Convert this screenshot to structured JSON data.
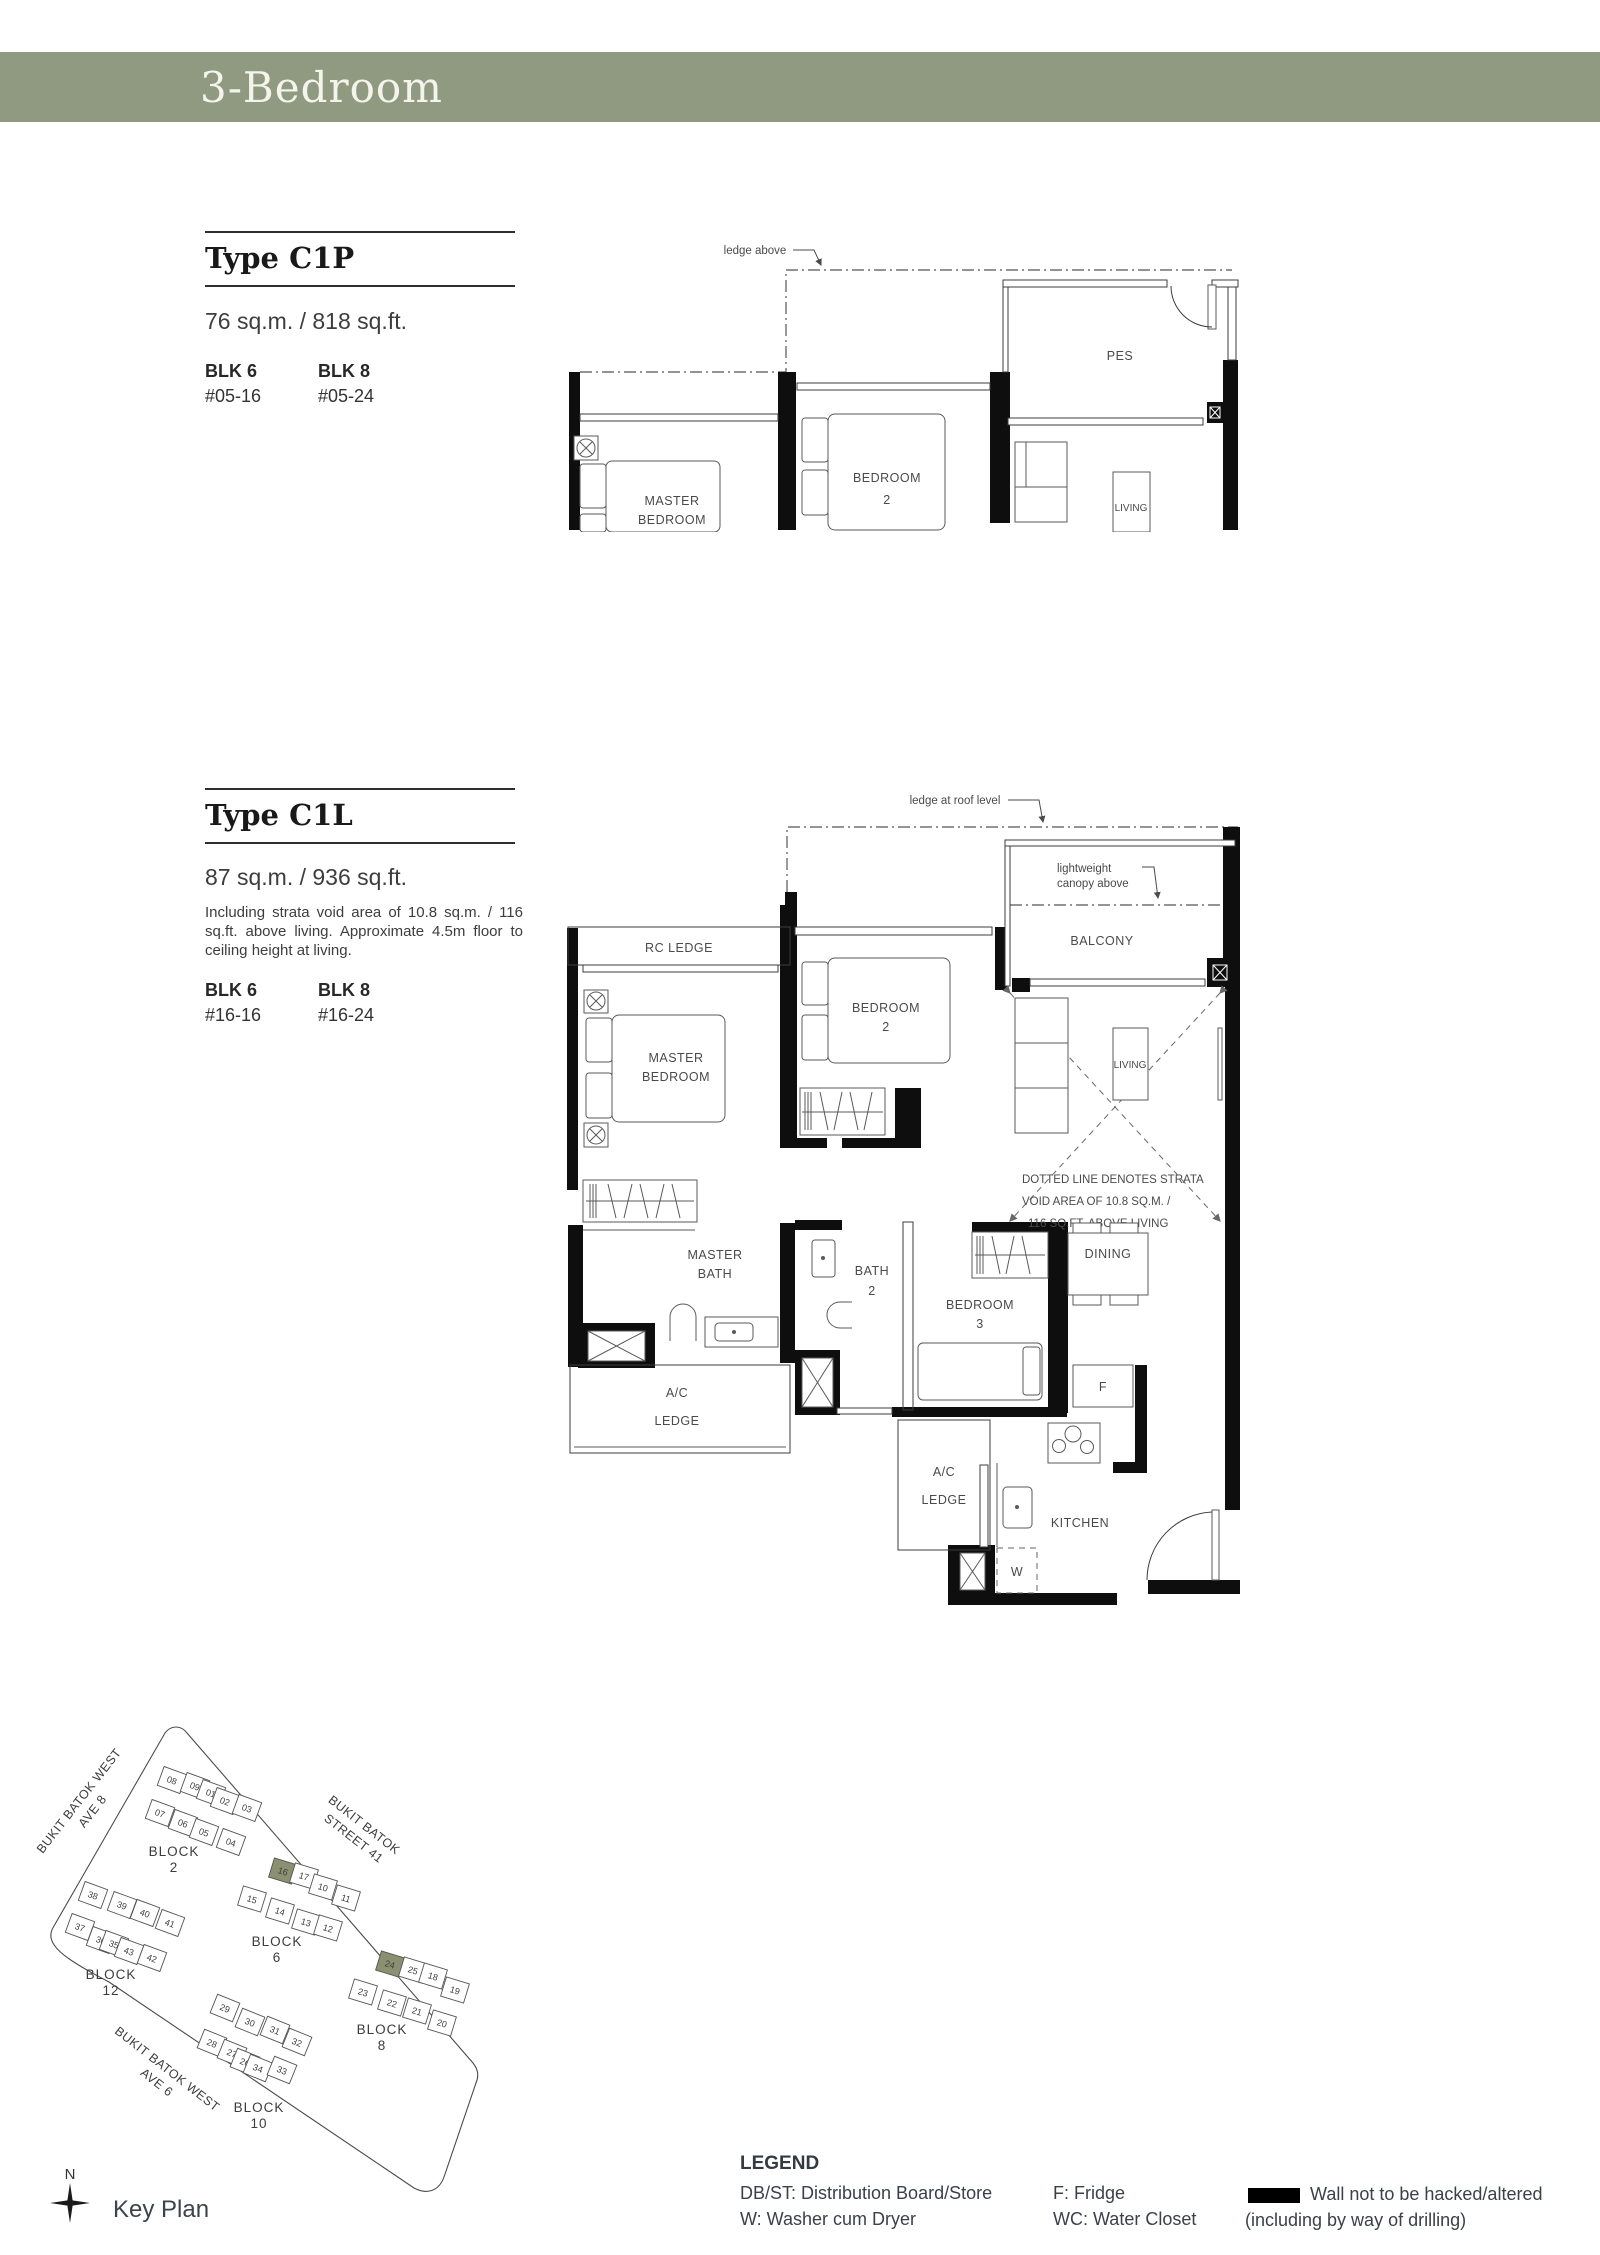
{
  "header": {
    "title": "3-Bedroom",
    "bar_color": "#8f9a80"
  },
  "c1p": {
    "title": "Type C1P",
    "area": "76 sq.m. / 818 sq.ft.",
    "stacks": [
      {
        "blk": "BLK 6",
        "unit": "#05-16"
      },
      {
        "blk": "BLK 8",
        "unit": "#05-24"
      }
    ],
    "plan": {
      "ledge_note": "ledge above",
      "rooms": {
        "master_line1": "MASTER",
        "master_line2": "BEDROOM",
        "bed2_line1": "BEDROOM",
        "bed2_line2": "2",
        "pes": "PES",
        "living": "LIVING"
      }
    }
  },
  "c1l": {
    "title": "Type C1L",
    "area": "87 sq.m. / 936 sq.ft.",
    "note": "Including strata void area of 10.8 sq.m. / 116 sq.ft. above living. Approximate 4.5m floor to ceiling height at living.",
    "stacks": [
      {
        "blk": "BLK 6",
        "unit": "#16-16"
      },
      {
        "blk": "BLK 8",
        "unit": "#16-24"
      }
    ],
    "plan": {
      "ledge_note": "ledge at roof level",
      "canopy_line1": "lightweight",
      "canopy_line2": "canopy above",
      "strata_line1": "DOTTED LINE DENOTES STRATA",
      "strata_line2": "VOID AREA OF 10.8 SQ.M. /",
      "strata_line3": "116 SQ.FT. ABOVE LIVING",
      "rooms": {
        "rc_ledge": "RC LEDGE",
        "balcony": "BALCONY",
        "master_line1": "MASTER",
        "master_line2": "BEDROOM",
        "bed2_line1": "BEDROOM",
        "bed2_line2": "2",
        "living": "LIVING",
        "master_bath_line1": "MASTER",
        "master_bath_line2": "BATH",
        "bath2_line1": "BATH",
        "bath2_line2": "2",
        "bed3_line1": "BEDROOM",
        "bed3_line2": "3",
        "dining": "DINING",
        "ac_line1": "A/C",
        "ac_line2": "LEDGE",
        "kitchen": "KITCHEN",
        "fridge": "F",
        "dbst_line1": "DB/",
        "dbst_line2": "ST",
        "washer": "W"
      }
    }
  },
  "key_plan": {
    "label": "Key Plan",
    "compass_label": "N",
    "highlight_color": "#8a9070",
    "streets": [
      {
        "line1": "BUKIT BATOK WEST",
        "line2": "AVE 8"
      },
      {
        "line1": "BUKIT BATOK",
        "line2": "STREET 41"
      },
      {
        "line1": "BUKIT BATOK WEST",
        "line2": "AVE 6"
      }
    ],
    "blocks": [
      {
        "rot": 20,
        "label": {
          "line1": "BLOCK",
          "line2": "2",
          "x": 149,
          "y": 141
        },
        "units": [
          {
            "n": "08",
            "x": 147,
            "y": 65
          },
          {
            "n": "09",
            "x": 170,
            "y": 71
          },
          {
            "n": "01",
            "x": 186,
            "y": 78
          },
          {
            "n": "02",
            "x": 200,
            "y": 86
          },
          {
            "n": "03",
            "x": 222,
            "y": 93
          },
          {
            "n": "07",
            "x": 135,
            "y": 98
          },
          {
            "n": "06",
            "x": 158,
            "y": 108
          },
          {
            "n": "05",
            "x": 179,
            "y": 117
          },
          {
            "n": "04",
            "x": 206,
            "y": 127
          }
        ]
      },
      {
        "rot": 17,
        "label": {
          "line1": "BLOCK",
          "line2": "6",
          "x": 252,
          "y": 231
        },
        "units": [
          {
            "n": "16",
            "x": 258,
            "y": 156,
            "hl": true
          },
          {
            "n": "17",
            "x": 279,
            "y": 161
          },
          {
            "n": "10",
            "x": 298,
            "y": 172
          },
          {
            "n": "11",
            "x": 321,
            "y": 183
          },
          {
            "n": "15",
            "x": 227,
            "y": 184
          },
          {
            "n": "14",
            "x": 255,
            "y": 196
          },
          {
            "n": "13",
            "x": 281,
            "y": 207
          },
          {
            "n": "12",
            "x": 303,
            "y": 213
          }
        ]
      },
      {
        "rot": 17,
        "label": {
          "line1": "BLOCK",
          "line2": "8",
          "x": 357,
          "y": 319
        },
        "units": [
          {
            "n": "24",
            "x": 365,
            "y": 249,
            "hl": true
          },
          {
            "n": "25",
            "x": 388,
            "y": 255
          },
          {
            "n": "18",
            "x": 408,
            "y": 261
          },
          {
            "n": "19",
            "x": 430,
            "y": 275
          },
          {
            "n": "23",
            "x": 338,
            "y": 277
          },
          {
            "n": "22",
            "x": 367,
            "y": 288
          },
          {
            "n": "21",
            "x": 392,
            "y": 296
          },
          {
            "n": "20",
            "x": 417,
            "y": 308
          }
        ]
      },
      {
        "rot": 20,
        "label": {
          "line1": "BLOCK",
          "line2": "12",
          "x": 86,
          "y": 264
        },
        "units": [
          {
            "n": "38",
            "x": 68,
            "y": 180
          },
          {
            "n": "39",
            "x": 97,
            "y": 190
          },
          {
            "n": "40",
            "x": 120,
            "y": 198
          },
          {
            "n": "41",
            "x": 145,
            "y": 208
          },
          {
            "n": "37",
            "x": 55,
            "y": 212
          },
          {
            "n": "36",
            "x": 76,
            "y": 225
          },
          {
            "n": "35",
            "x": 89,
            "y": 229
          },
          {
            "n": "43",
            "x": 104,
            "y": 236
          },
          {
            "n": "42",
            "x": 127,
            "y": 243
          }
        ]
      },
      {
        "rot": 22,
        "label": {
          "line1": "BLOCK",
          "line2": "10",
          "x": 234,
          "y": 397
        },
        "units": [
          {
            "n": "29",
            "x": 200,
            "y": 293
          },
          {
            "n": "30",
            "x": 225,
            "y": 307
          },
          {
            "n": "31",
            "x": 250,
            "y": 315
          },
          {
            "n": "32",
            "x": 272,
            "y": 327
          },
          {
            "n": "28",
            "x": 187,
            "y": 328
          },
          {
            "n": "27",
            "x": 207,
            "y": 338
          },
          {
            "n": "26",
            "x": 220,
            "y": 347
          },
          {
            "n": "34",
            "x": 233,
            "y": 353
          },
          {
            "n": "33",
            "x": 257,
            "y": 355
          }
        ]
      }
    ]
  },
  "legend": {
    "title": "LEGEND",
    "col1_line1": "DB/ST: Distribution Board/Store",
    "col1_line2": "W: Washer cum Dryer",
    "col2_line1": "F: Fridge",
    "col2_line2": "WC: Water Closet",
    "wall_line1": "Wall not to be hacked/altered",
    "wall_line2": "(including by way of drilling)"
  }
}
